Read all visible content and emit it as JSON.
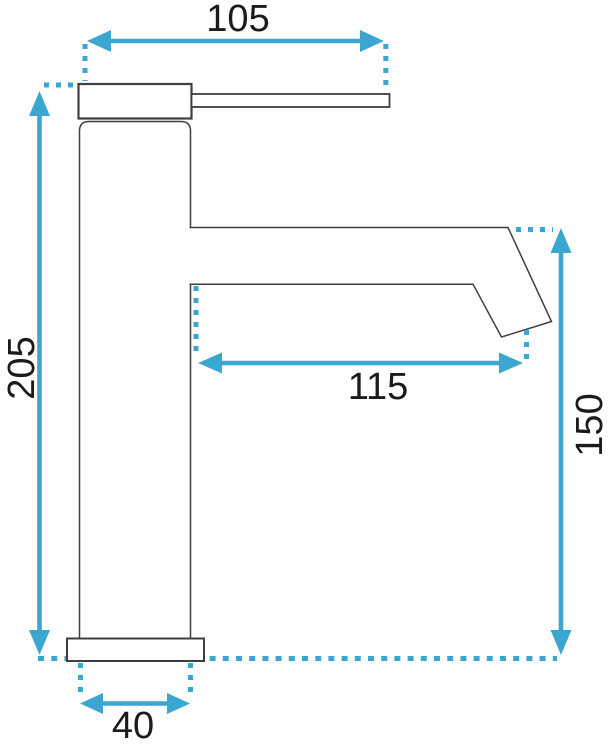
{
  "colors": {
    "accent": "#3BA6CF",
    "outline": "#3F3F3F",
    "text": "#1B1B1B",
    "background": "#FFFFFF"
  },
  "drawing": {
    "type": "technical-dimension-drawing",
    "subject": "single-lever basin faucet, side view",
    "dimensions": {
      "top_width": "105",
      "total_height": "205",
      "spout_reach": "115",
      "spout_height": "150",
      "body_diameter": "40"
    }
  }
}
